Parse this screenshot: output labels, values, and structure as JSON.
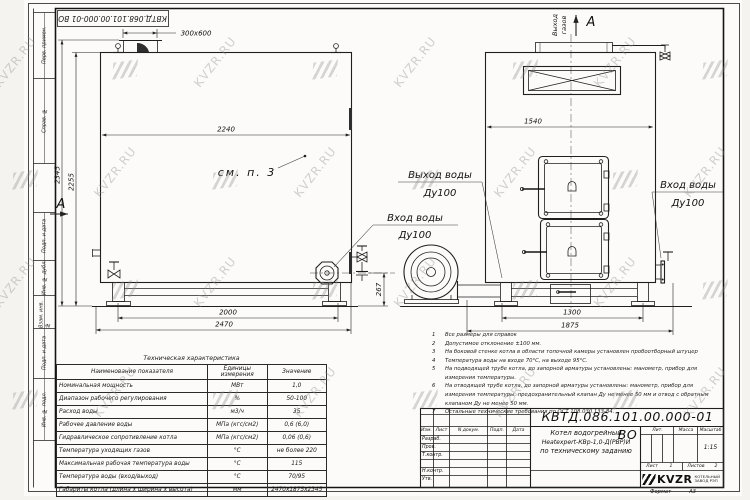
{
  "stamps": {
    "top_left": "КВТД.068.101.00.000-01 ВО"
  },
  "watermark": {
    "text": "KVZR.RU"
  },
  "margin_labels": [
    "Перв. примен.",
    "Справ. №",
    "Подп. и дата",
    "Инв. № дубл.",
    "Взам. инв. №",
    "Подп. и дата",
    "Инв. № подл."
  ],
  "dims": {
    "flue": "300x600",
    "top_width": "2240",
    "total_height": "2345",
    "body_height": "2255",
    "base_span": "2000",
    "total_length": "2470",
    "pipe_h": "267",
    "front_width": "1540",
    "front_base": "1300",
    "front_total": "1875"
  },
  "labels": {
    "see_note": "см. п. 3",
    "section_a": "А",
    "view_a": "А",
    "gas_out_line1": "Выход",
    "gas_out_line2": "газов",
    "water_outlet": {
      "line1": "Выход воды",
      "line2": "Ду100"
    },
    "water_inlet": {
      "line1": "Вход воды",
      "line2": "Ду100"
    },
    "water_inlet_right": {
      "line1": "Вход воды",
      "line2": "Ду100"
    }
  },
  "notes": [
    {
      "num": "1",
      "text": "Все размеры для справок"
    },
    {
      "num": "2",
      "text": "Допустимое отклонение ±100 мм."
    },
    {
      "num": "3",
      "text": "На боковой стенке котла в области топочной камеры установлен пробоотборный штуцер"
    },
    {
      "num": "4",
      "text": "Температура воды на входе 70°С, на выходе 95°С."
    },
    {
      "num": "5",
      "text": "На подводящей трубе котла, до запорной арматуры установлены: манометр, прибор для измерения температуры."
    },
    {
      "num": "6",
      "text": "На отводящей трубе котла, до запорной арматуры установлены: манометр, прибор для измерения температуры, предохранительный клапан Ду не менее 50 мм и отвод с обратным клапаном Ду не менее 50 мм."
    },
    {
      "num": "7",
      "text": "Остальные технические требования по ОСТ 108.030.133-84."
    }
  ],
  "spec_table": {
    "title": "Техническая характеристика",
    "headers": [
      "Наименование показателя",
      "Единицы измерения",
      "Значение"
    ],
    "rows": [
      [
        "Номинальная мощность",
        "МВт",
        "1,0"
      ],
      [
        "Диапазон рабочего регулирования",
        "%",
        "50-100"
      ],
      [
        "Расход воды",
        "м3/ч",
        "35"
      ],
      [
        "Рабочее давление воды",
        "МПа (кгс/см2)",
        "0,6 (6,0)"
      ],
      [
        "Гидравлическое сопротивление котла",
        "МПа (кгс/см2)",
        "0,06 (0,6)"
      ],
      [
        "Температура уходящих газов",
        "°С",
        "не более 220"
      ],
      [
        "Максимальная рабочая температура воды",
        "°С",
        "115"
      ],
      [
        "Температура воды (вход/выход)",
        "°С",
        "70/95"
      ],
      [
        "Габариты котла (длина х ширина х высота)",
        "мм",
        "2470х1875х2345"
      ]
    ]
  },
  "title_block": {
    "doc_number": "КВТД.086.101.00.000-01 ВО",
    "header_cols": [
      "Изм.",
      "Лист",
      "N докум.",
      "Подп.",
      "Дата"
    ],
    "row_labels": [
      "Разраб.",
      "Пров.",
      "Т.контр.",
      "",
      "Н.контр.",
      "Утв."
    ],
    "name_line1": "Котел водогрейный",
    "name_line2": "Heatexpert-КВр-1,0-Д(РВР)И",
    "name_line3": "по техническому заданию",
    "lit_label": "Лит.",
    "mass_label": "Масса",
    "scale_label": "Масштаб",
    "scale_value": "1:15",
    "sheet_label": "Лист",
    "sheet_value": "1",
    "sheets_label": "Листов",
    "sheets_value": "2",
    "logo_text": "KVZR",
    "company_line1": "КОТЕЛЬНЫЙ",
    "company_line2": "ЗАВОД РЭП",
    "format_label": "Формат",
    "format_value": "А3"
  }
}
